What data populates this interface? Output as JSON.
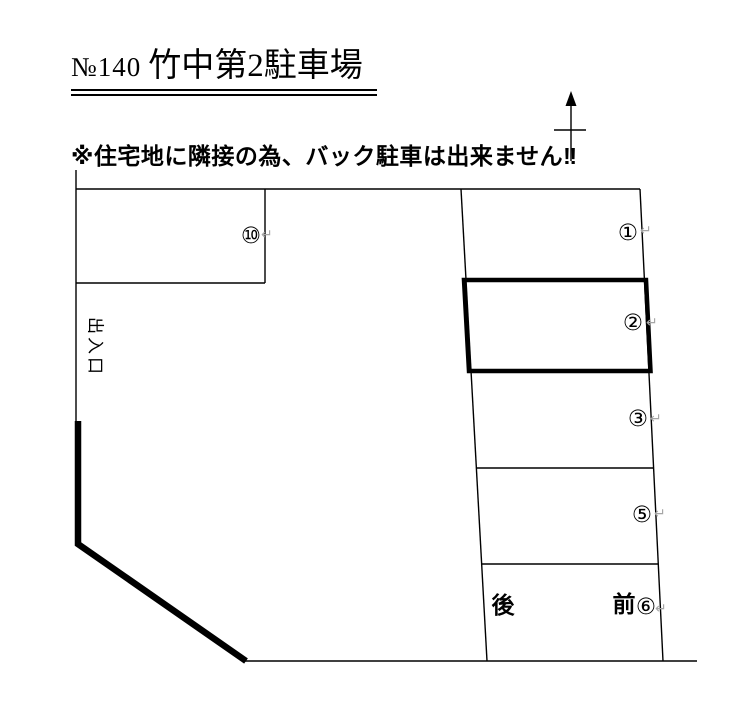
{
  "title": {
    "number": "№140",
    "name": "竹中第2駐車場"
  },
  "warning": "※住宅地に隣接の為、バック駐車は出来ません‼",
  "diagram": {
    "entrance_label": "出入口",
    "back_label": "後",
    "front_label": "前",
    "return_mark": "↵",
    "spaces": [
      {
        "id": "1",
        "label": "①",
        "outline": "normal"
      },
      {
        "id": "2",
        "label": "②",
        "outline": "bold"
      },
      {
        "id": "3",
        "label": "③",
        "outline": "normal"
      },
      {
        "id": "5",
        "label": "⑤",
        "outline": "normal"
      },
      {
        "id": "6",
        "label": "⑥",
        "outline": "normal"
      },
      {
        "id": "10",
        "label": "⑩",
        "outline": "normal"
      }
    ],
    "colors": {
      "line": "#000000",
      "return_mark": "#a6a6a6",
      "background": "#ffffff"
    }
  }
}
